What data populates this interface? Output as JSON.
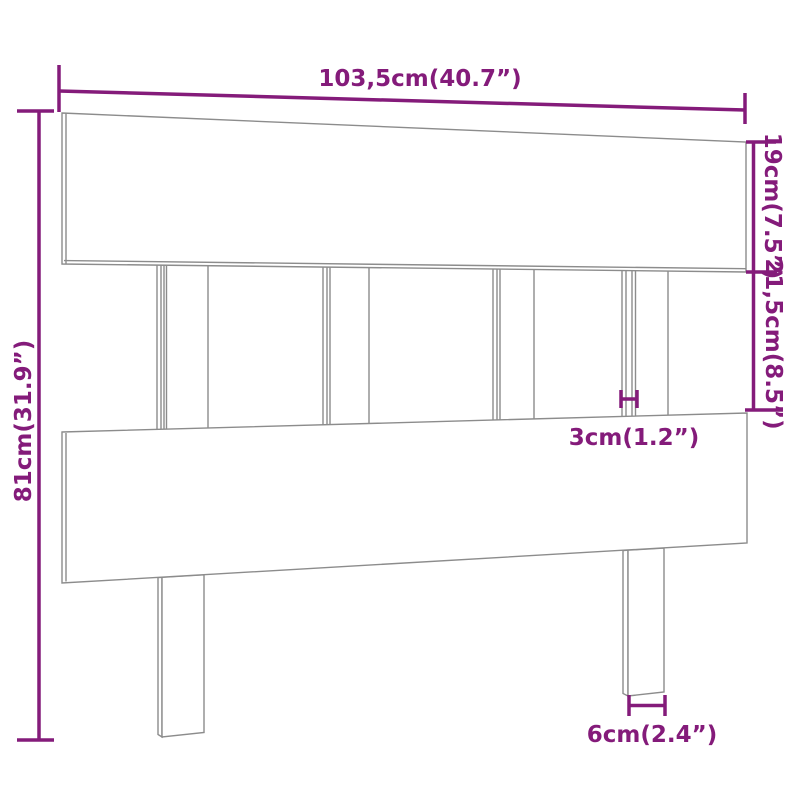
{
  "page": {
    "title": "Headboard dimension diagram",
    "background": "#ffffff"
  },
  "drawing": {
    "outline_color": "#8c8c8c",
    "fill_color": "#ffffff",
    "parts": {
      "top_board": "top board",
      "bottom_board": "bottom board",
      "slats": "vertical slats",
      "left_leg": "left leg",
      "right_leg": "right leg"
    }
  },
  "dimensions": {
    "accent_color": "#841b7a",
    "width": {
      "label": "103,5cm(40.7”)",
      "cm": 103.5,
      "inch": 40.7
    },
    "total_height": {
      "label": "81cm(31.9”)",
      "cm": 81,
      "inch": 31.9
    },
    "top_board_height": {
      "label": "19cm(7.5”)",
      "cm": 19,
      "inch": 7.5
    },
    "gap_height": {
      "label": "21,5cm(8.5”)",
      "cm": 21.5,
      "inch": 8.5
    },
    "slat_thickness": {
      "label": "3cm(1.2”)",
      "cm": 3,
      "inch": 1.2
    },
    "leg_width": {
      "label": "6cm(2.4”)",
      "cm": 6,
      "inch": 2.4
    }
  }
}
